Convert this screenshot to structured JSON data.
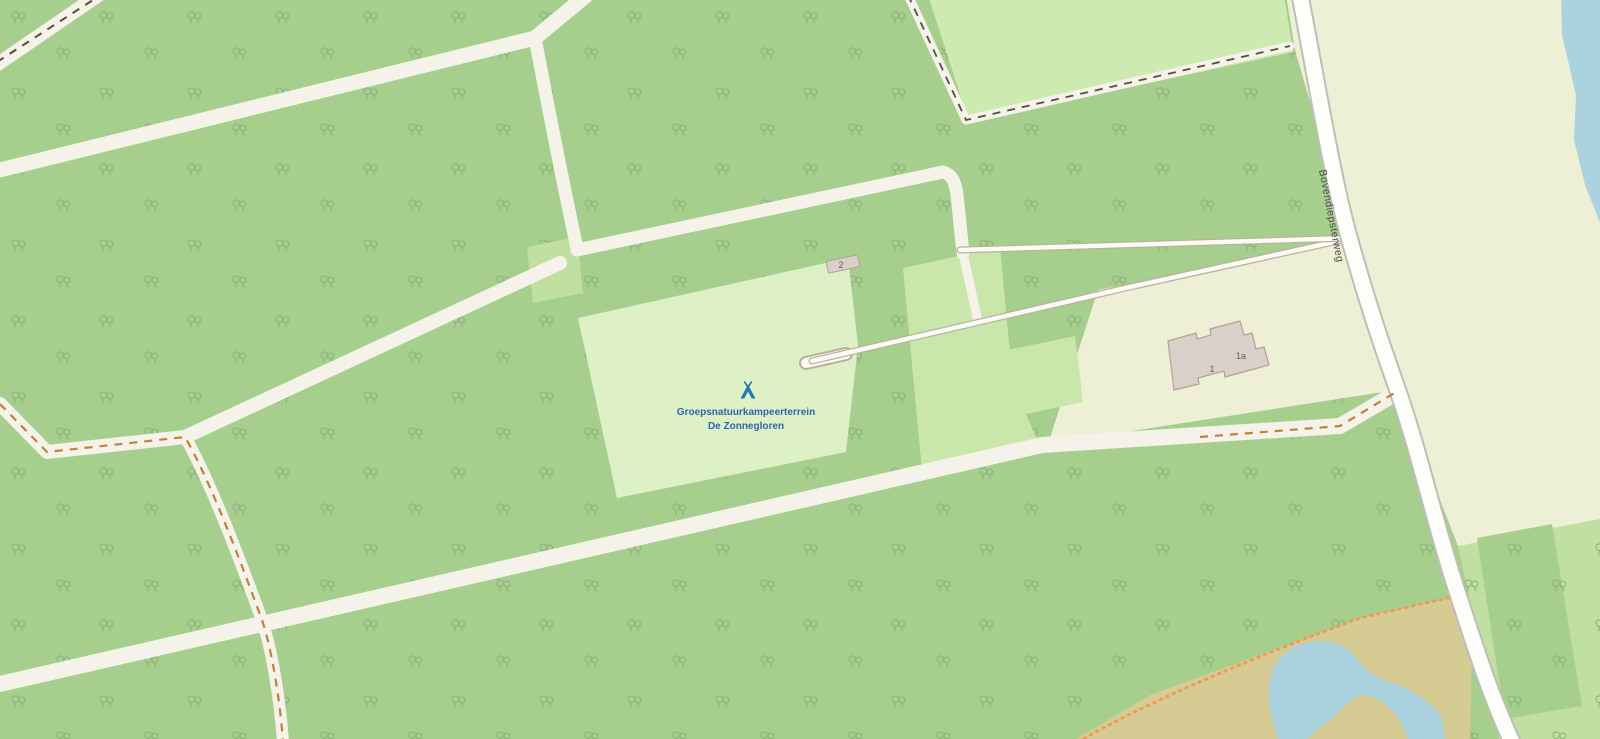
{
  "map": {
    "labels": {
      "campsite_line1": "Groepsnatuurkampeerterrein",
      "campsite_line2": "De Zonnegloren",
      "road_name": "Bovendiepsterweg",
      "building_1": "1",
      "building_1a": "1a",
      "building_2": "2"
    },
    "colors": {
      "forest": "#a6cf8e",
      "tree_stroke": "#8cb377",
      "meadow": "#cdebb0",
      "grass": "#c9e7ab",
      "grass_dark": "#bfe0a0",
      "campsite": "#def0c5",
      "farmland": "#eef0d5",
      "heath": "#d6cc93",
      "water": "#aad3df",
      "road_fill": "#f5f2ea",
      "track_fill": "#fbfaf4",
      "track_casing": "#b9b29b",
      "major_road_fill": "#fdfdfa",
      "major_road_casing": "#bfbdb7",
      "building_fill": "#d9d0c9",
      "building_stroke": "#b2a293",
      "dash_dark": "#5a4d3d",
      "dash_orange": "#bd8339",
      "dot_orange": "#ee9b57",
      "campsite_label": "#2e66ab",
      "campsite_icon": "#1f78b4",
      "road_label_color": "#4a4a4a",
      "building_label_color": "#645f55"
    }
  }
}
